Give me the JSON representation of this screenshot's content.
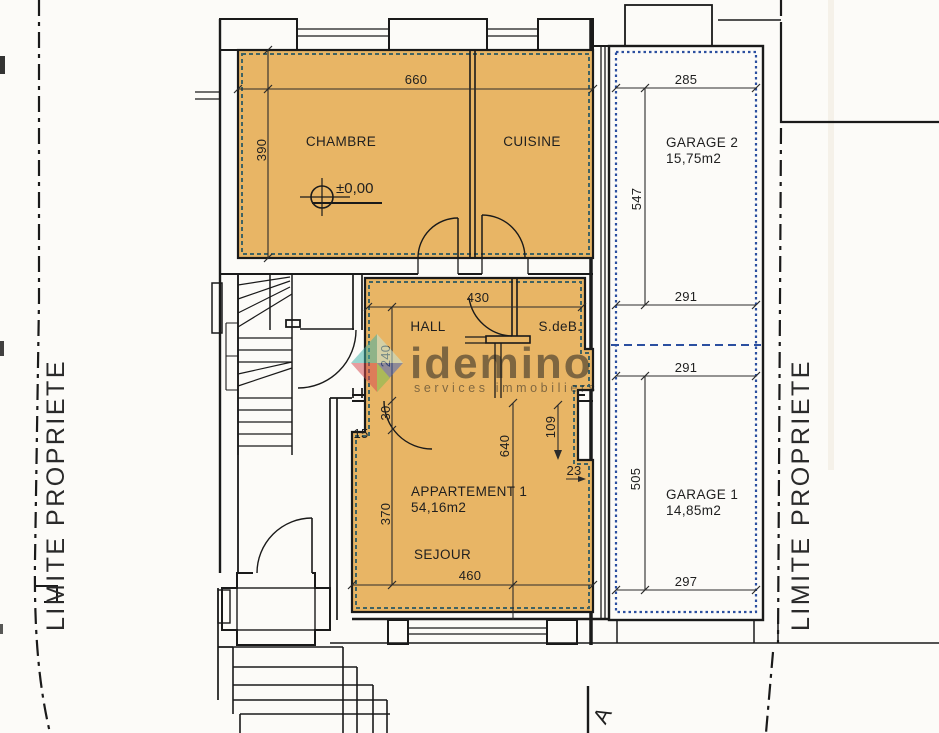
{
  "colors": {
    "room_fill": "#e8b565",
    "plan_line": "#1a1a1a",
    "apartment_dash": "#3f6363",
    "garage_dash": "#2b4fa0",
    "dim_line": "#2b2b2b",
    "watermark_text": "#8f8a80",
    "logo_teal": "#3fb3a9",
    "logo_light": "#c3e9e3",
    "logo_red": "#d4494f",
    "logo_blue": "#3f63c6",
    "logo_green": "#76bd4e"
  },
  "labels": {
    "chambre": "CHAMBRE",
    "cuisine": "CUISINE",
    "hall": "HALL",
    "sdeb": "S.deB.",
    "apartment": "APPARTEMENT 1",
    "apartment_area": "54,16m2",
    "sejour": "SEJOUR",
    "garage2": "GARAGE 2",
    "garage2_area": "15,75m2",
    "garage1": "GARAGE 1",
    "garage1_area": "14,85m2",
    "level": "±0,00",
    "limite_left": "LIMITE PROPRIETE",
    "limite_right": "LIMITE PROPRIETE",
    "section": "A"
  },
  "dimensions": {
    "d660": "660",
    "d390": "390",
    "d430": "430",
    "d240": "240",
    "d30": "30",
    "d15": "15",
    "d370": "370",
    "d640": "640",
    "d109": "109",
    "d23": "23",
    "d460": "460",
    "d285": "285",
    "d547": "547",
    "d291_top": "291",
    "d291_mid": "291",
    "d505": "505",
    "d297": "297"
  },
  "watermark": {
    "brand": "idemino",
    "tagline": "services  immobiliers"
  }
}
